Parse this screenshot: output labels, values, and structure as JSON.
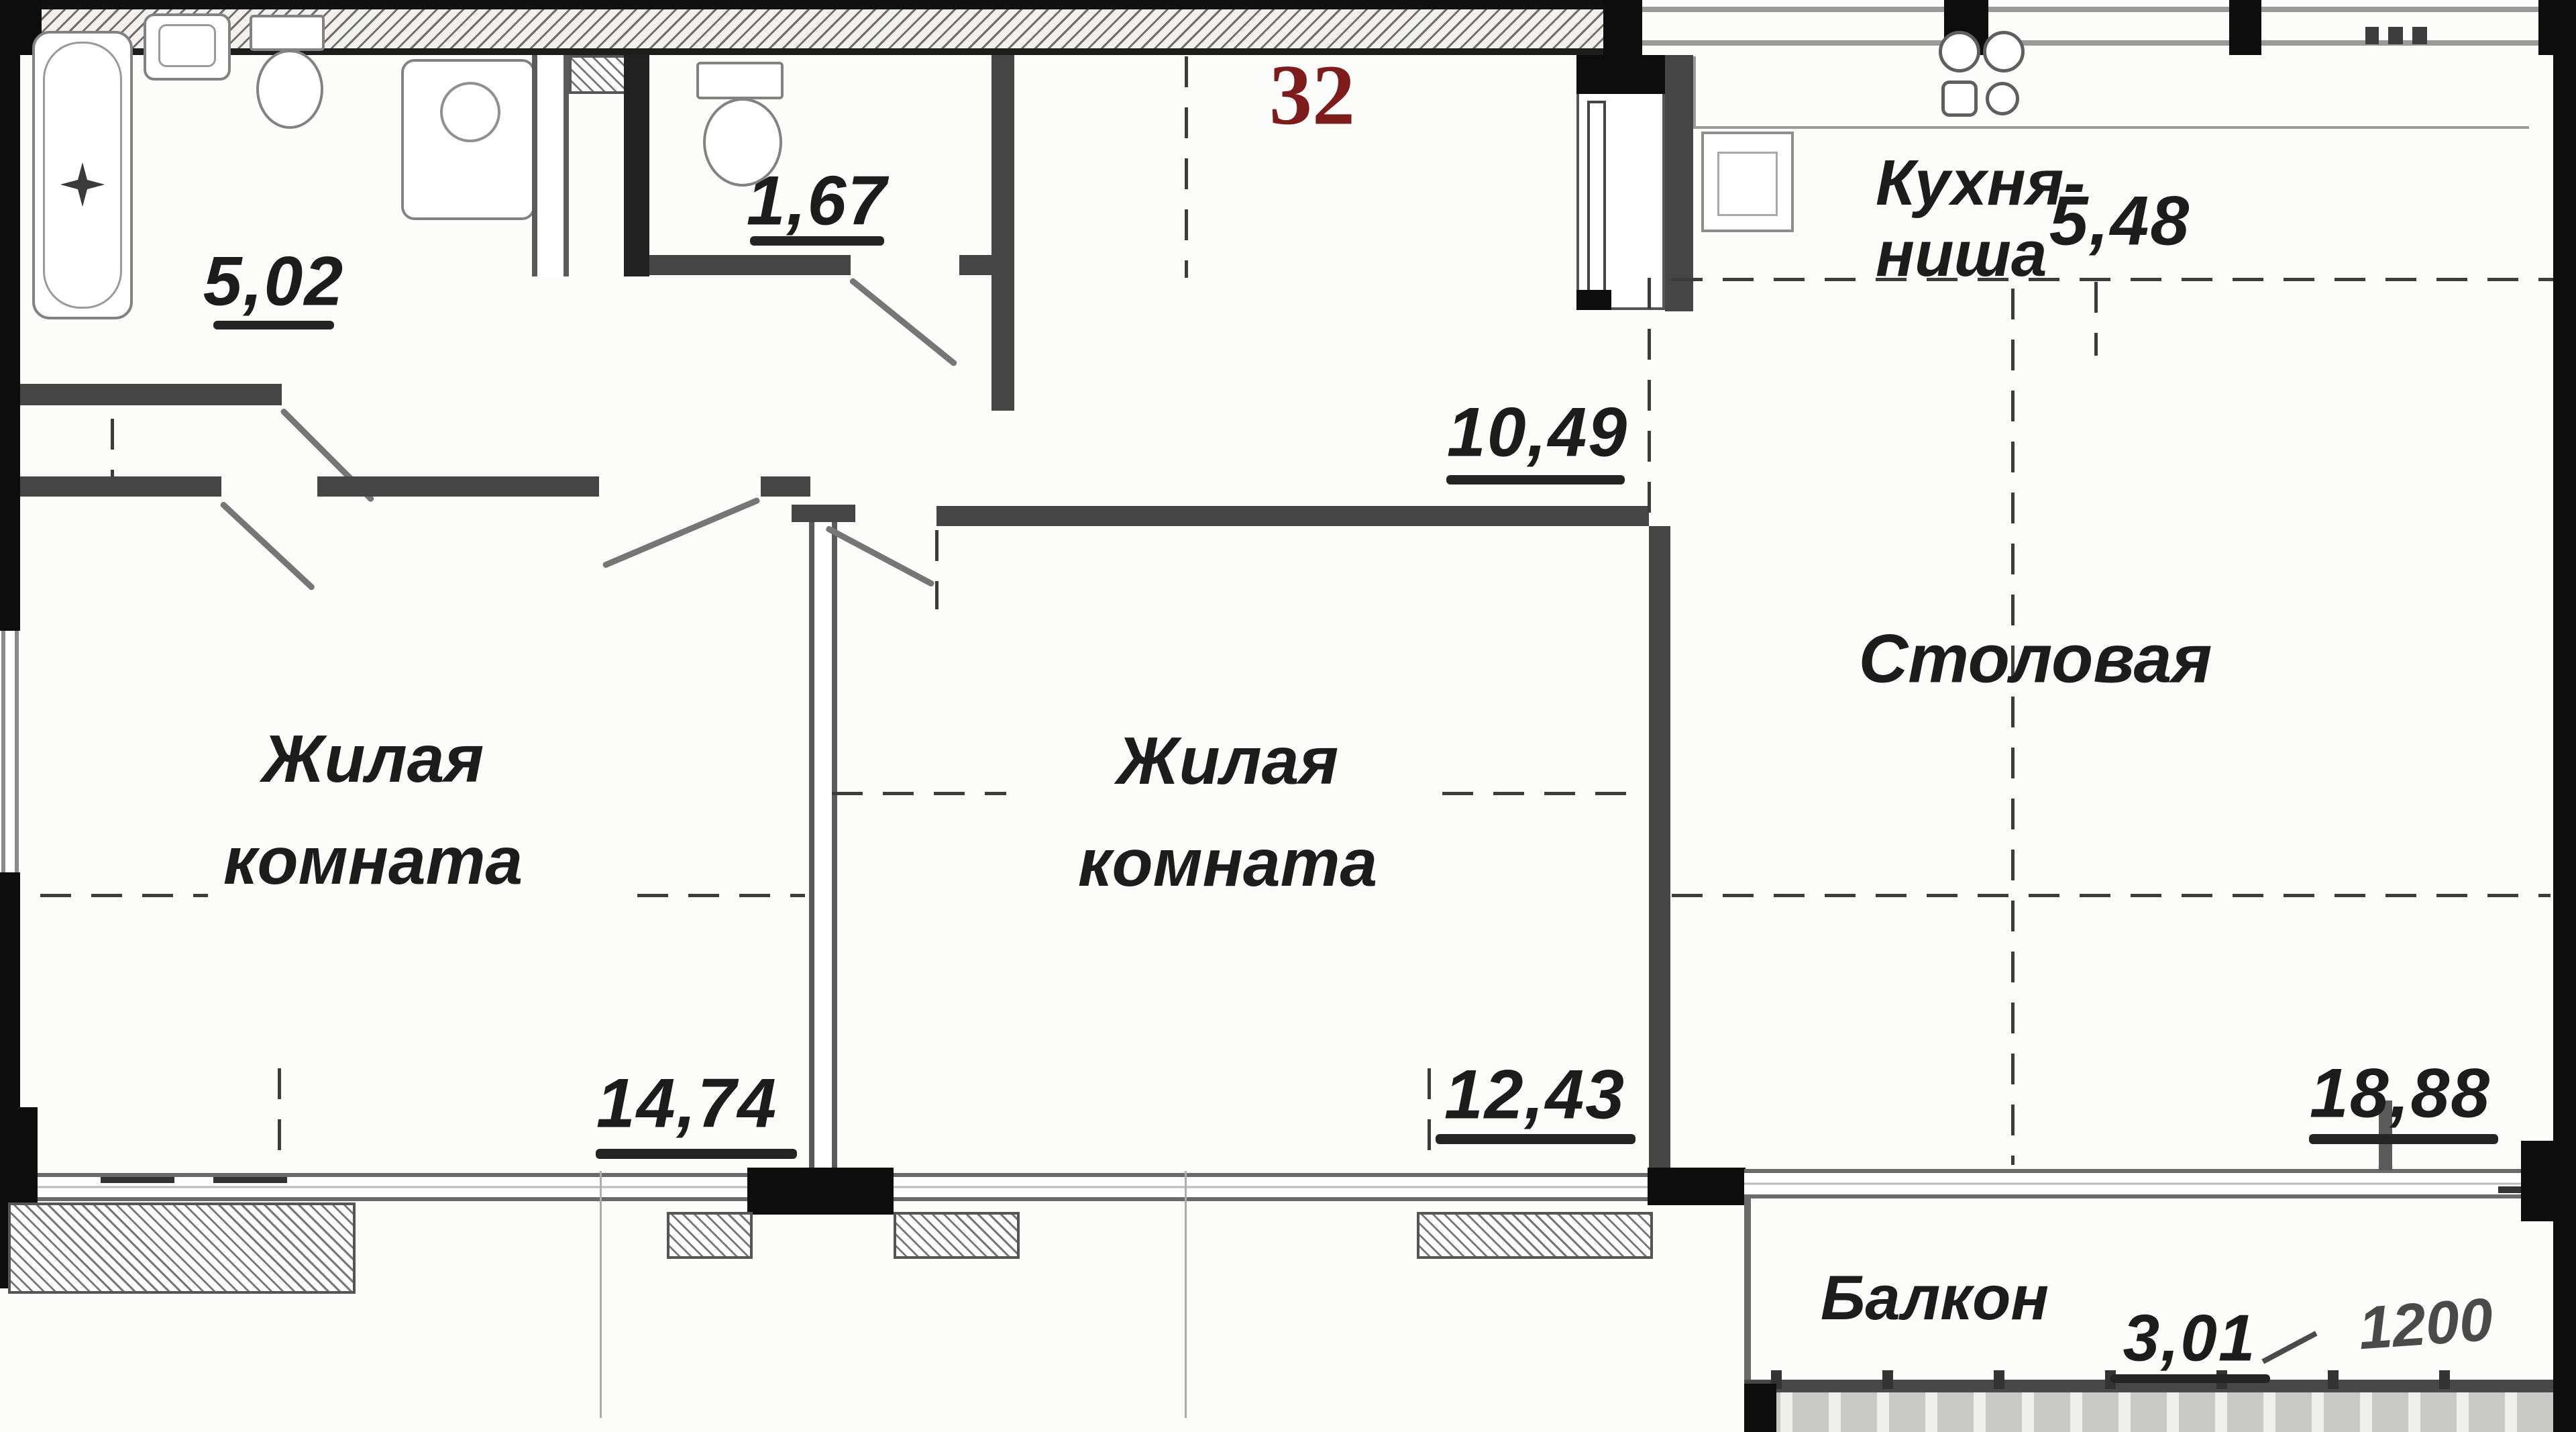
{
  "apartment": {
    "number": "32"
  },
  "rooms": {
    "bathroom": {
      "area": "5,02"
    },
    "wc": {
      "area": "1,67"
    },
    "hall": {
      "area": "10,49"
    },
    "kitchen": {
      "name_line1": "Кухня-",
      "name_line2": "ниша",
      "area": "5,48"
    },
    "dining": {
      "name": "Столовая",
      "area": "18,88"
    },
    "living1": {
      "name_line1": "Жилая",
      "name_line2": "комната",
      "area": "14,74"
    },
    "living2": {
      "name_line1": "Жилая",
      "name_line2": "комната",
      "area": "12,43"
    },
    "balcony": {
      "name": "Балкон",
      "area": "3,01",
      "dimension": "1200"
    }
  },
  "icons": [
    "bathtub-icon",
    "drain-star-icon",
    "sink-icon",
    "toilet-icon",
    "washing-machine-icon",
    "stove-burners-icon",
    "kitchen-sink-icon",
    "vent-dots-icon"
  ],
  "colors": {
    "apartment_number": "#7e1c1c",
    "label": "#1c1c1c",
    "wall": "#454545",
    "wall_black": "#0d0d0d"
  }
}
